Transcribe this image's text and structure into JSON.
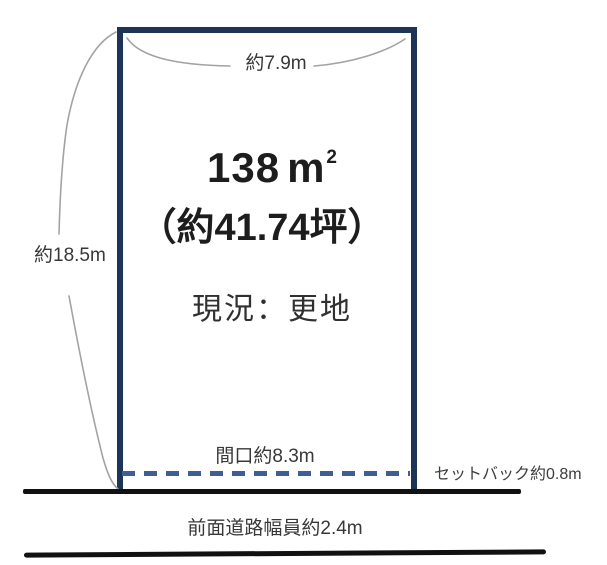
{
  "diagram": {
    "title": "land-plot-layout",
    "colors": {
      "boundary": "#1c3557",
      "setback_dash": "#3e5f94",
      "road_line": "#111111",
      "bracket": "#a3a3a3",
      "text": "#1d1d1d"
    },
    "top_width": {
      "label": "約7.9m"
    },
    "left_height": {
      "label": "約18.5m"
    },
    "area": {
      "value": "138",
      "unit": "m",
      "sup": "2",
      "tsubo": "（約41.74坪）"
    },
    "status": {
      "label": "現況：更地"
    },
    "frontage": {
      "label": "間口約8.3m"
    },
    "setback": {
      "label": "セットバック約0.8m"
    },
    "front_road": {
      "label": "前面道路幅員約2.4m"
    }
  }
}
